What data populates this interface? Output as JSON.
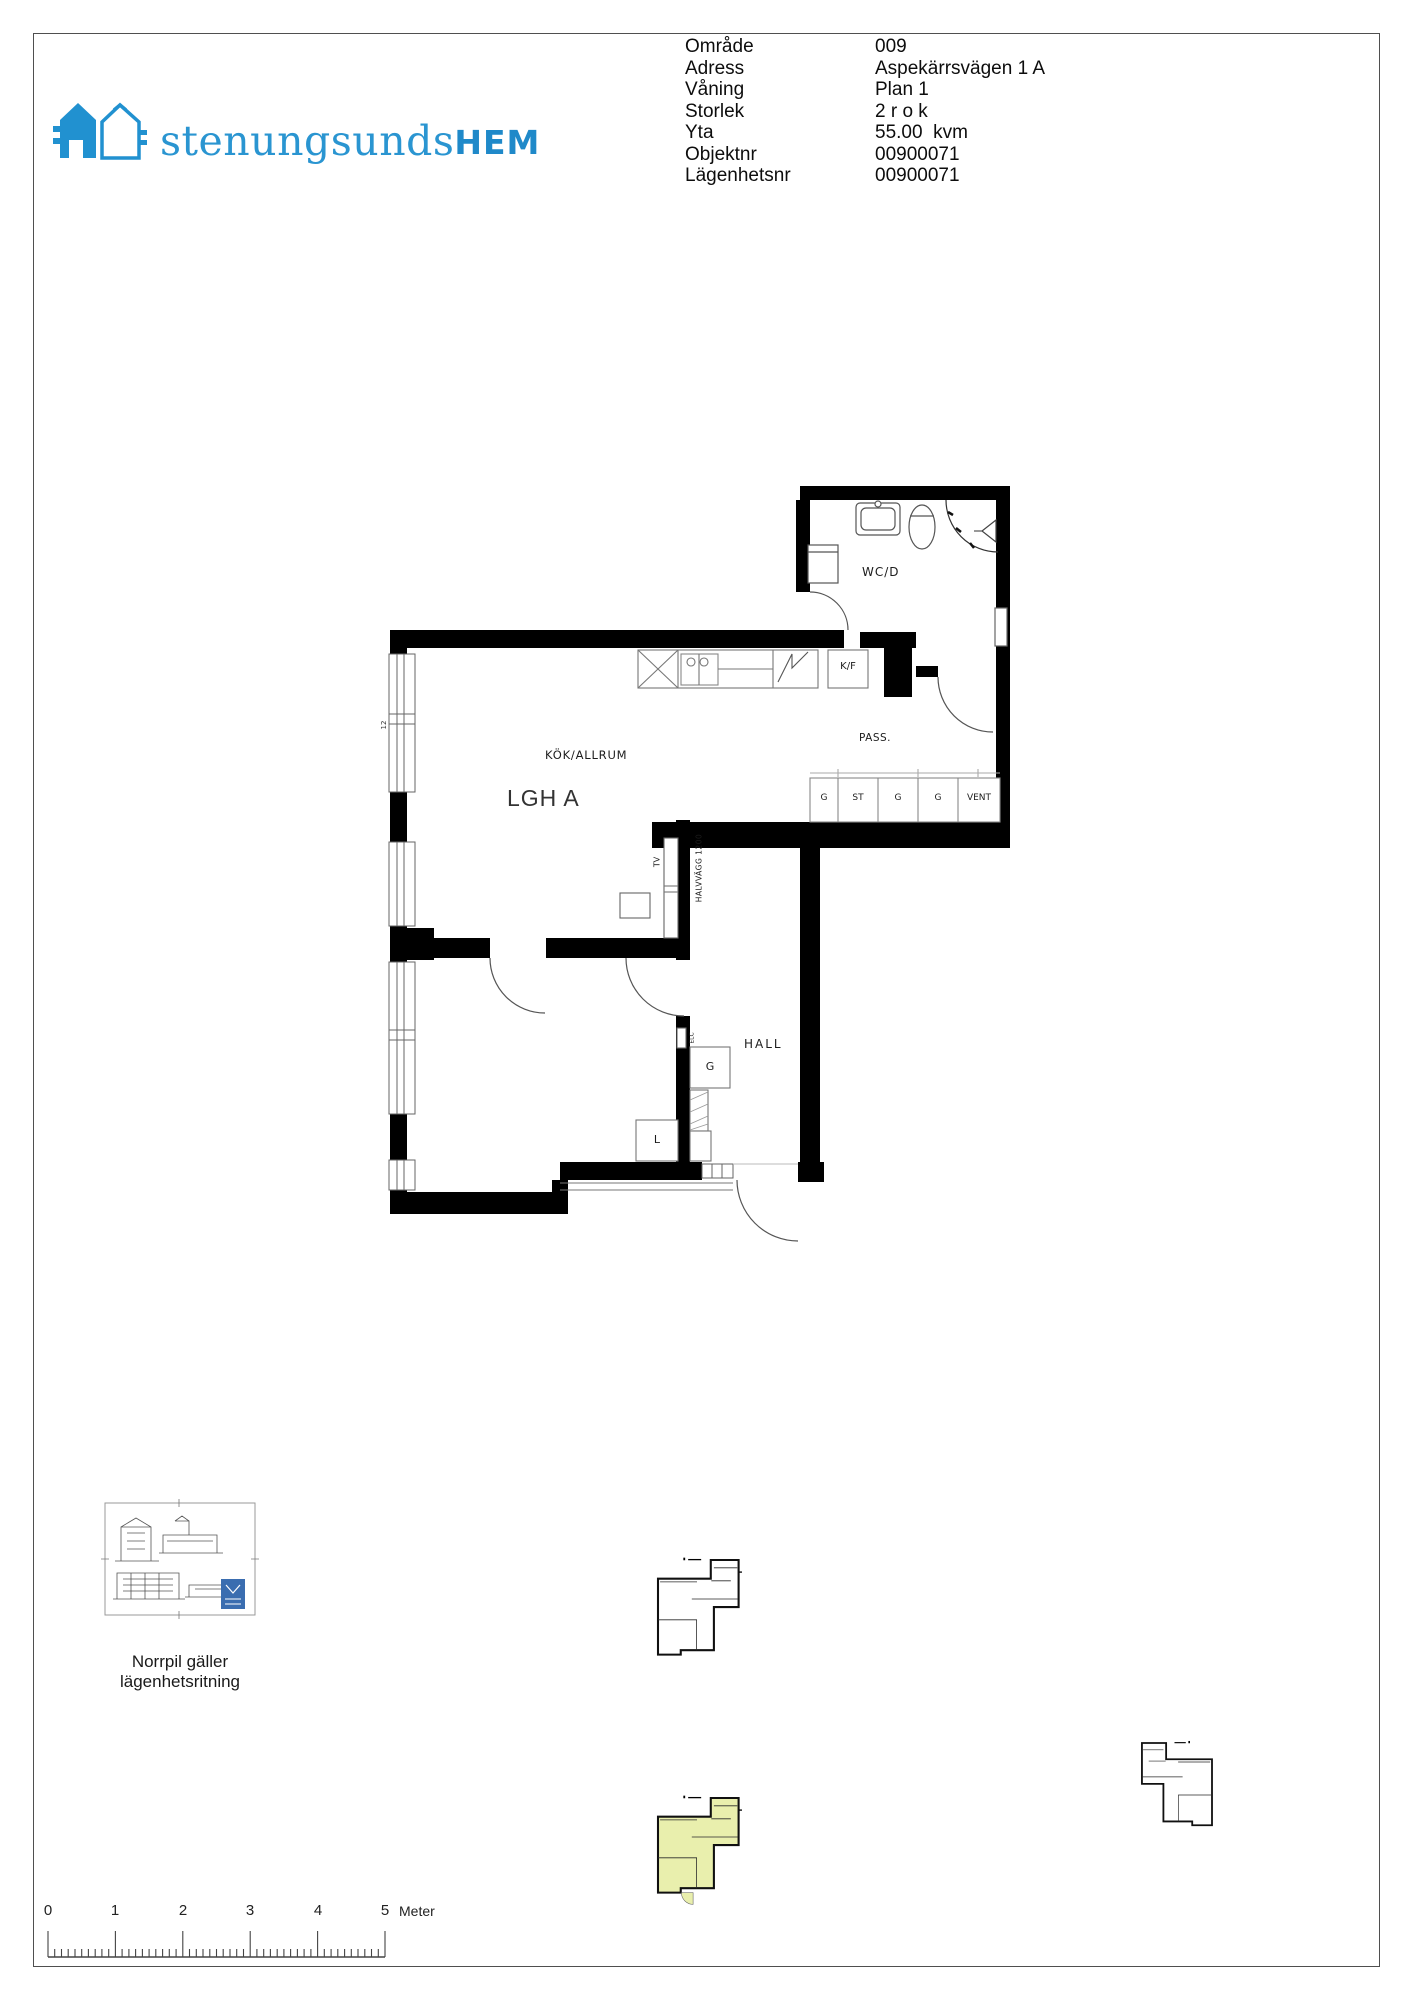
{
  "logo": {
    "text_light": "stenungsunds",
    "text_bold": "HEM",
    "color": "#2191d0"
  },
  "info": {
    "rows": [
      {
        "label": "Område",
        "value": "009"
      },
      {
        "label": "Adress",
        "value": "Aspekärrsvägen 1 A"
      },
      {
        "label": "Våning",
        "value": "Plan 1"
      },
      {
        "label": "Storlek",
        "value": "2 r o k"
      },
      {
        "label": "Yta",
        "value": "55.00  kvm"
      },
      {
        "label": "Objektnr",
        "value": "00900071"
      },
      {
        "label": "Lägenhetsnr",
        "value": "00900071"
      }
    ]
  },
  "plan": {
    "apartment_label": "LGH A",
    "room_wcd": "WC/D",
    "room_pass": "PASS.",
    "room_kok": "KÖK/ALLRUM",
    "room_hall": "HALL",
    "fridge": "K/F",
    "closets": [
      "G",
      "ST",
      "G",
      "G",
      "VENT"
    ],
    "hall_closet": "G",
    "linen_closet": "L",
    "tv": "TV",
    "half_wall": "HALVVÄGG 1200",
    "elc": "ELC",
    "wall_mark": "12"
  },
  "footer": {
    "north_note_line1": "Norrpil gäller",
    "north_note_line2": "lägenhetsritning",
    "scale_ticks": [
      "0",
      "1",
      "2",
      "3",
      "4",
      "5"
    ],
    "scale_unit": "Meter"
  },
  "colors": {
    "highlight": "#e9efad",
    "logo_blue": "#2191d0"
  }
}
